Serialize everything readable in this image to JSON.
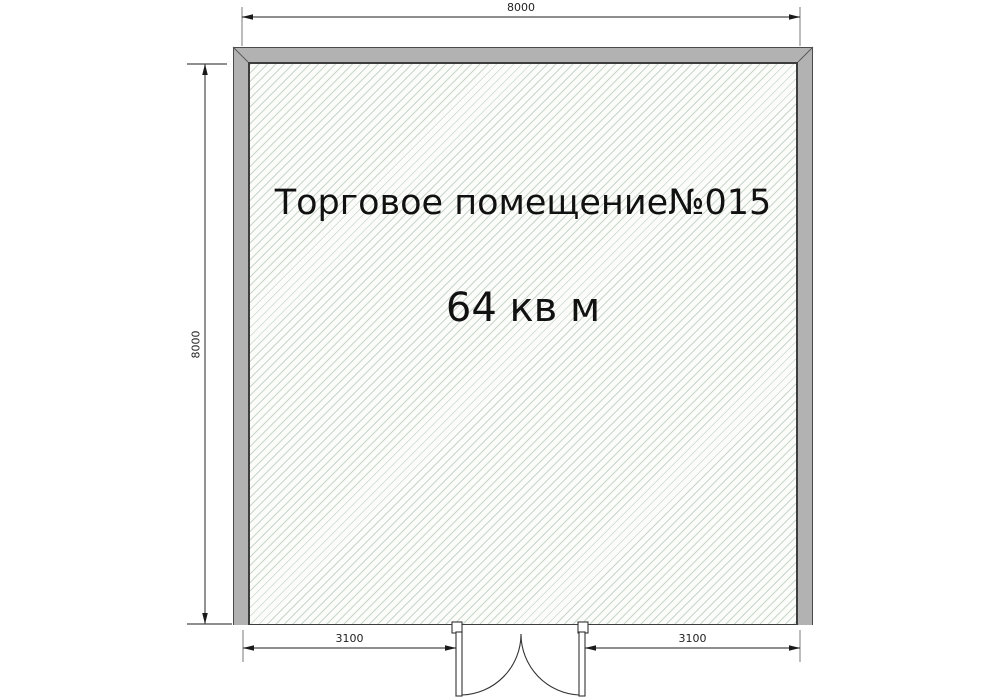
{
  "room": {
    "name": "Торговое помещение№015",
    "area": "64 кв м"
  },
  "dimensions": {
    "top": "8000",
    "left": "8000",
    "bottom_left": "3100",
    "bottom_right": "3100"
  },
  "colors": {
    "background": "#ffffff",
    "wall_fill": "#b2b2b2",
    "wall_outline": "#4a4a4a",
    "hatch_line": "#c9d6c9",
    "hatch_background": "#fcfdfb",
    "dimension_line": "#4a4a4a",
    "text": "#111111"
  }
}
